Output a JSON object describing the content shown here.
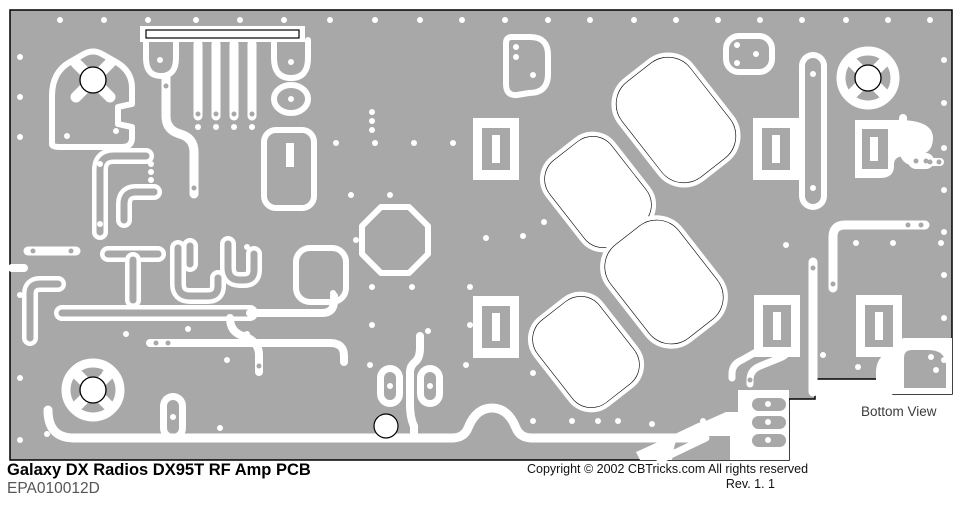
{
  "footer": {
    "title": "Galaxy DX Radios DX95T RF Amp PCB",
    "part_number": "EPA010012D",
    "copyright": "Copyright © 2002 CBTricks.com  All rights reserved",
    "revision": "Rev. 1. 1"
  },
  "board": {
    "view_label": "Bottom View"
  },
  "colors": {
    "board_gray": "#a8a8a8",
    "trace_white": "#ffffff",
    "outline_black": "#000000",
    "page_background": "#ffffff"
  }
}
